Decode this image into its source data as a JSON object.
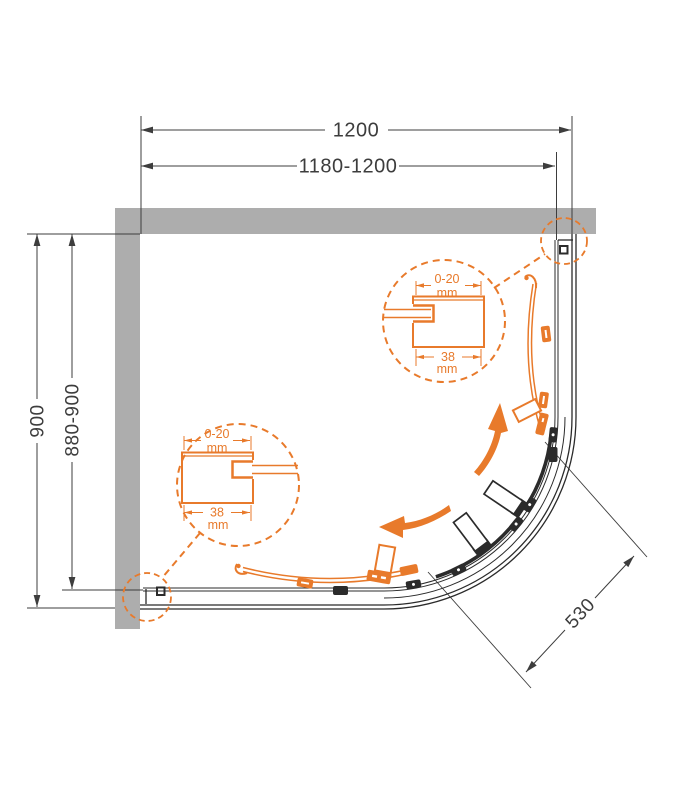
{
  "drawing": {
    "type": "quadrant-shower-enclosure-plan",
    "dimensions": {
      "width_total": "1200",
      "width_adjust": "1180-1200",
      "depth_total": "900",
      "depth_adjust": "880-900",
      "entry_width": "530"
    },
    "details": [
      {
        "id": "wall-profile-top-right",
        "adjust": "0-20",
        "adjust_unit": "mm",
        "profile_width": "38",
        "profile_unit": "mm"
      },
      {
        "id": "wall-profile-bottom-left",
        "adjust": "0-20",
        "adjust_unit": "mm",
        "profile_width": "38",
        "profile_unit": "mm"
      }
    ]
  },
  "colors": {
    "accent": "#E87A2B",
    "line": "#2B2B2B",
    "dim": "#3D3D3D",
    "wall": "#ADADAD",
    "bg": "#FFFFFF"
  }
}
